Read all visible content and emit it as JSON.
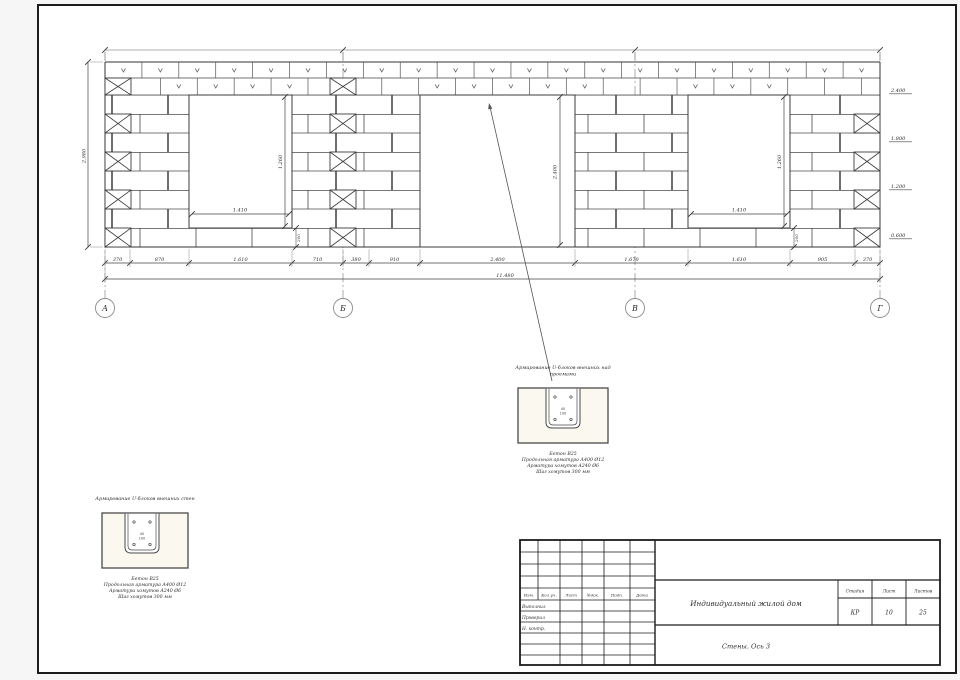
{
  "sheet": {
    "axes": [
      "А",
      "Б",
      "В",
      "Г"
    ],
    "dimensions": {
      "bottom_chain": [
        "370",
        "870",
        "1.610",
        "710",
        "380",
        "910",
        "2.400",
        "1.670",
        "1.610",
        "905",
        "370"
      ],
      "total_length": "11.480",
      "wall_height": "2.980",
      "window_left_width": "1.410",
      "window_left_height": "1.260",
      "door_height": "2.400",
      "window_right_width": "1.410",
      "window_right_height": "1.260",
      "sill_left": "200",
      "sill_right": "200",
      "elevation_marks": [
        "2.400",
        "1.800",
        "1.200",
        "0.600"
      ]
    },
    "details": [
      {
        "title_lines": [
          "Армирование U-блоков внешних стен",
          ""
        ],
        "caption_lines": [
          "Бетон В25",
          "Продольная арматура А400 Ø12",
          "Арматура хомутов А240 Ø6",
          "Шаг хомутов 300 мм"
        ],
        "inner_dims": [
          "40",
          "100"
        ]
      },
      {
        "title_lines": [
          "Армирование U-блоков внешних над",
          "проемами"
        ],
        "caption_lines": [
          "Бетон В25",
          "Продольная арматура А400 Ø12",
          "Арматура хомутов А240 Ø6",
          "Шаг хомутов 300 мм"
        ],
        "inner_dims": [
          "40",
          "100"
        ]
      }
    ],
    "title_block": {
      "revision_header": [
        "Изм.",
        "Кол.уч.",
        "Лист",
        "№док.",
        "Подп.",
        "Дата"
      ],
      "role_rows": [
        "Выполнил",
        "Проверил",
        "Н. контр."
      ],
      "project_name": "Индивидуальный жилой дом",
      "sheet_name": "Стены. Ось 3",
      "stage_header": [
        "Стадия",
        "Лист",
        "Листов"
      ],
      "stage_values": [
        "КР",
        "10",
        "25"
      ]
    },
    "colors": {
      "line": "#3c3c3c",
      "dim": "#4a4a4a",
      "detail_fill": "#fbf8f0"
    }
  }
}
